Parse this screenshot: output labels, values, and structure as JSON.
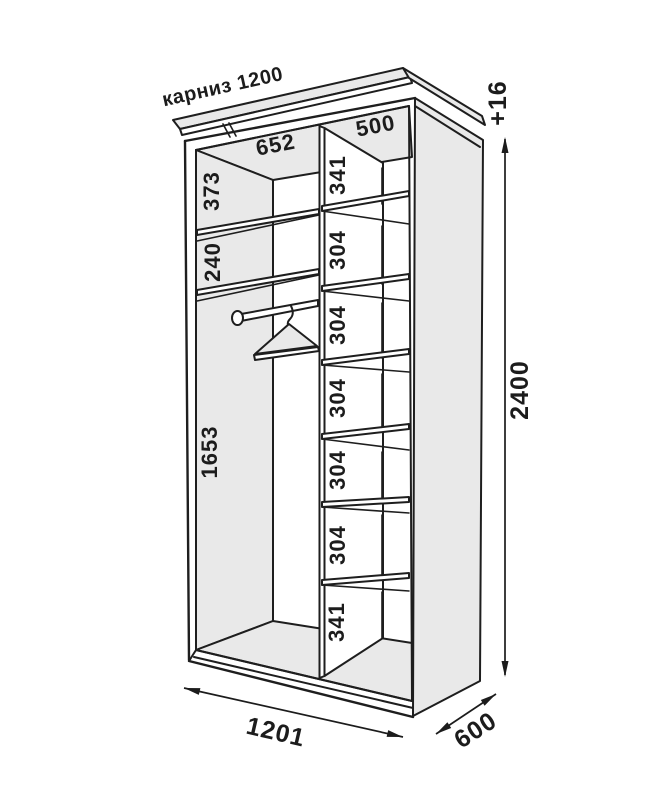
{
  "diagram": {
    "type": "wardrobe-assembly-drawing",
    "colors": {
      "panel_fill": "#e9e9e9",
      "line_color": "#1e1e1e",
      "bg": "#ffffff"
    },
    "labels": {
      "cornice": "карниз 1200",
      "left_section_width": "652",
      "right_section_width": "500",
      "left_heights": [
        "373",
        "240",
        "1653"
      ],
      "right_heights": [
        "341",
        "304",
        "304",
        "304",
        "304",
        "304",
        "341"
      ],
      "total_height": "2400",
      "height_tolerance": "+16",
      "total_width": "1201",
      "depth": "600"
    }
  }
}
